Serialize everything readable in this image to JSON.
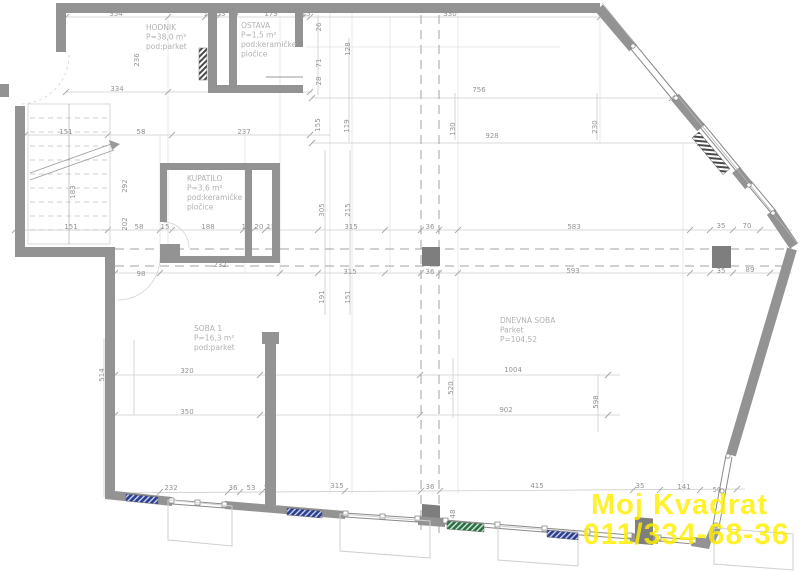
{
  "meta": {
    "type": "architectural-floor-plan"
  },
  "watermark": {
    "line1": "Moj Kvadrat",
    "line2": "011/334-68-36",
    "color": "#ffee00"
  },
  "rooms": [
    {
      "x": 146,
      "y": 30,
      "lines": [
        "HODNIK",
        "P=38,0 m²",
        "pod:parket"
      ]
    },
    {
      "x": 241,
      "y": 28,
      "lines": [
        "OSTAVA",
        "P=1,5 m²",
        "pod:keramičke",
        "pločice"
      ]
    },
    {
      "x": 187,
      "y": 181,
      "lines": [
        "KUPATILO",
        "P=3,6 m²",
        "pod:keramičke",
        "pločice"
      ]
    },
    {
      "x": 194,
      "y": 331,
      "lines": [
        "SOBA 1",
        "P=16,3 m²",
        "pod:parket"
      ]
    },
    {
      "x": 500,
      "y": 323,
      "lines": [
        "DNEVNA SOBA",
        "Parket",
        "P=104,52"
      ]
    }
  ],
  "dimensions": [
    {
      "t": "354",
      "x": 116,
      "y": 16
    },
    {
      "t": "15",
      "x": 208,
      "y": 16
    },
    {
      "t": "53",
      "x": 221,
      "y": 16
    },
    {
      "t": "15",
      "x": 234,
      "y": 16
    },
    {
      "t": "173",
      "x": 271,
      "y": 16
    },
    {
      "t": "15",
      "x": 306,
      "y": 16
    },
    {
      "t": "330",
      "x": 450,
      "y": 16
    },
    {
      "t": "236",
      "x": 139,
      "y": 60,
      "r": -90
    },
    {
      "t": "26",
      "x": 321,
      "y": 27,
      "r": -90
    },
    {
      "t": "71",
      "x": 321,
      "y": 63,
      "r": -90
    },
    {
      "t": "28",
      "x": 321,
      "y": 81,
      "r": -90
    },
    {
      "t": "128",
      "x": 350,
      "y": 49,
      "r": -90
    },
    {
      "t": "334",
      "x": 117,
      "y": 91
    },
    {
      "t": "351",
      "x": 251,
      "y": 91
    },
    {
      "t": "183",
      "x": 75,
      "y": 192,
      "r": -90
    },
    {
      "t": "292",
      "x": 127,
      "y": 186,
      "r": -90
    },
    {
      "t": "202",
      "x": 127,
      "y": 224,
      "r": -90
    },
    {
      "t": "151",
      "x": 66,
      "y": 134
    },
    {
      "t": "58",
      "x": 141,
      "y": 134
    },
    {
      "t": "237",
      "x": 244,
      "y": 134
    },
    {
      "t": "155",
      "x": 320,
      "y": 125,
      "r": -90
    },
    {
      "t": "119",
      "x": 349,
      "y": 126,
      "r": -90
    },
    {
      "t": "130",
      "x": 455,
      "y": 129,
      "r": -90
    },
    {
      "t": "230",
      "x": 597,
      "y": 127,
      "r": -90
    },
    {
      "t": "756",
      "x": 479,
      "y": 92
    },
    {
      "t": "928",
      "x": 492,
      "y": 138
    },
    {
      "t": "305",
      "x": 324,
      "y": 210,
      "r": -90
    },
    {
      "t": "215",
      "x": 350,
      "y": 210,
      "r": -90
    },
    {
      "t": "191",
      "x": 324,
      "y": 297,
      "r": -90
    },
    {
      "t": "151",
      "x": 350,
      "y": 297,
      "r": -90
    },
    {
      "t": "151",
      "x": 71,
      "y": 229
    },
    {
      "t": "58",
      "x": 139,
      "y": 229
    },
    {
      "t": "15",
      "x": 165,
      "y": 229
    },
    {
      "t": "188",
      "x": 208,
      "y": 229
    },
    {
      "t": "15",
      "x": 246,
      "y": 229
    },
    {
      "t": "20",
      "x": 259,
      "y": 229
    },
    {
      "t": "15",
      "x": 271,
      "y": 229
    },
    {
      "t": "315",
      "x": 351,
      "y": 229
    },
    {
      "t": "36",
      "x": 430,
      "y": 229
    },
    {
      "t": "583",
      "x": 574,
      "y": 229
    },
    {
      "t": "35",
      "x": 721,
      "y": 228
    },
    {
      "t": "70",
      "x": 747,
      "y": 228
    },
    {
      "t": "98",
      "x": 141,
      "y": 276
    },
    {
      "t": "232",
      "x": 220,
      "y": 267
    },
    {
      "t": "315",
      "x": 350,
      "y": 274
    },
    {
      "t": "36",
      "x": 430,
      "y": 274
    },
    {
      "t": "593",
      "x": 573,
      "y": 273
    },
    {
      "t": "35",
      "x": 721,
      "y": 273
    },
    {
      "t": "89",
      "x": 750,
      "y": 272
    },
    {
      "t": "514",
      "x": 104,
      "y": 375,
      "r": -90
    },
    {
      "t": "320",
      "x": 187,
      "y": 373
    },
    {
      "t": "1004",
      "x": 513,
      "y": 372
    },
    {
      "t": "520",
      "x": 453,
      "y": 388,
      "r": -90
    },
    {
      "t": "598",
      "x": 598,
      "y": 402,
      "r": -90
    },
    {
      "t": "350",
      "x": 187,
      "y": 414
    },
    {
      "t": "902",
      "x": 506,
      "y": 412
    },
    {
      "t": "232",
      "x": 171,
      "y": 490
    },
    {
      "t": "36",
      "x": 233,
      "y": 490
    },
    {
      "t": "53",
      "x": 251,
      "y": 490
    },
    {
      "t": "29",
      "x": 268,
      "y": 490
    },
    {
      "t": "315",
      "x": 337,
      "y": 488
    },
    {
      "t": "36",
      "x": 430,
      "y": 489
    },
    {
      "t": "415",
      "x": 537,
      "y": 488
    },
    {
      "t": "35",
      "x": 640,
      "y": 488
    },
    {
      "t": "141",
      "x": 684,
      "y": 489
    },
    {
      "t": "50",
      "x": 717,
      "y": 492
    },
    {
      "t": "48",
      "x": 455,
      "y": 514,
      "r": -90
    }
  ],
  "colors": {
    "wall": "#939393",
    "column": "#7e7e7e",
    "dim_line": "#cccccc",
    "dim_text": "#949494",
    "room_text": "#b2b2b2",
    "radiator_blue": "#2e3f8e",
    "radiator_green": "#2e6e46",
    "watermark": "#ffee00"
  }
}
